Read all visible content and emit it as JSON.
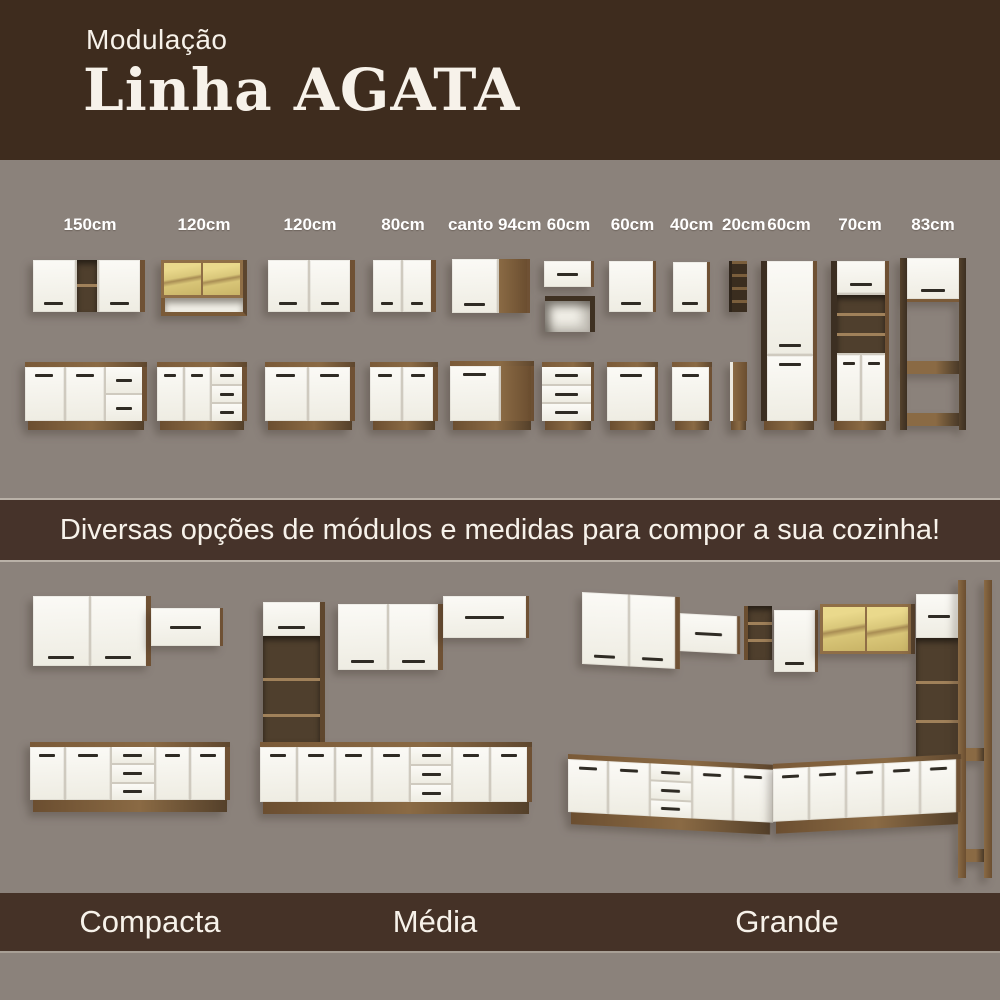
{
  "header": {
    "kicker": "Modulação",
    "title": "Linha AGATA"
  },
  "modules": {
    "labels": [
      "150cm",
      "120cm",
      "120cm",
      "80cm",
      "canto 94cm",
      "60cm",
      "60cm",
      "40cm",
      "20cm",
      "60cm",
      "70cm",
      "83cm"
    ]
  },
  "banner": {
    "text": "Diversas opções de módulos e medidas para compor a sua cozinha!"
  },
  "kitchens": {
    "labels": [
      "Compacta",
      "Média",
      "Grande"
    ]
  },
  "colors": {
    "header_bg": "#3e2c1e",
    "banner_bg": "#46332a",
    "footer_bg": "#453227",
    "canvas_bg": "#8b827b",
    "wood": "#7c5c3a",
    "door_white": "#f6f4ee",
    "glass": "#ddca7e",
    "text": "#f7f2ea"
  }
}
